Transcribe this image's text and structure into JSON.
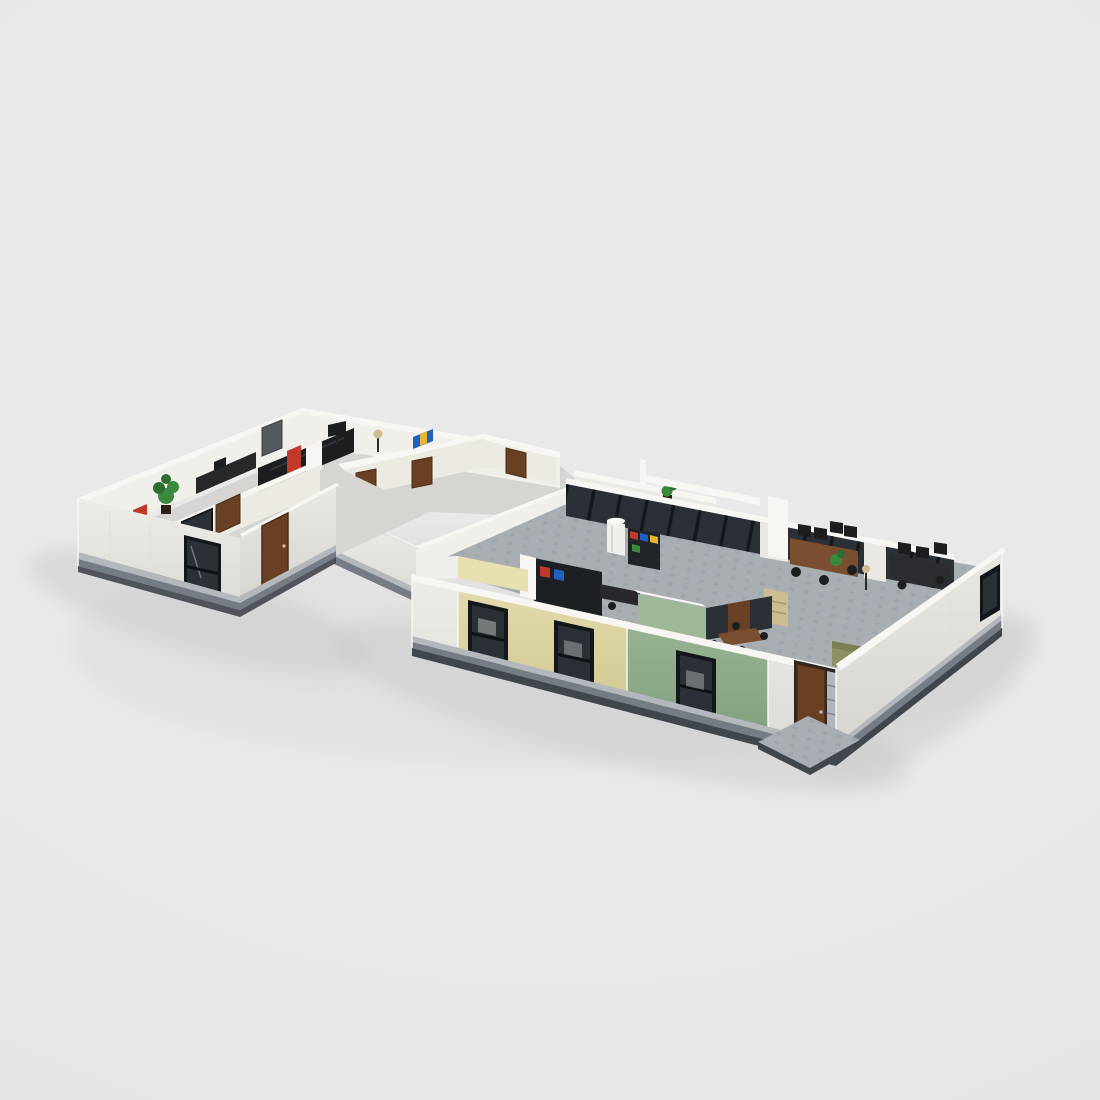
{
  "scene": {
    "description": "Isometric digital render of a LEGO-style office building model (open-top floor plan with two connected wings) on a plain light gray studio background",
    "style": "LEGO brick MOC render, dollhouse top-open view, no text or UI elements visible",
    "canvas": {
      "width": 1100,
      "height": 1100
    },
    "palette": {
      "bg": "#e9e9e9",
      "bg-edge": "#e1e1e1",
      "shadow": "#c9c9c9",
      "wall": "#eae8e3",
      "wall2": "#e5e3de",
      "wall-top": "#f7f6f3",
      "wall-inner": "#f1efe9",
      "wall-inner2": "#eceae3",
      "base-light": "#b4b8bd",
      "base-dark": "#767c84",
      "plinth": "#41464d",
      "floor-left": "#d7d5d1",
      "floor-tile": "#a9aeb3",
      "stud": "#999fa5",
      "accent-yellow": "#ddd6a2",
      "yellow-inner": "#e7e0b0",
      "accent-green": "#90ad8d",
      "green-inner": "#9fb89a",
      "door-brown": "#6a4024",
      "door-brown-dark": "#4a2c16",
      "glass": "#2b3036",
      "glass-frame": "#14171a",
      "black": "#1b1d1f",
      "graphite": "#55585c",
      "desk": "#7a4f30",
      "red": "#c0392b",
      "blue": "#2060c0",
      "yellow-item": "#e3b72e",
      "tan": "#cdbd92",
      "olive": "#8f9062",
      "plant": "#3a8a3e",
      "plant-dark": "#2c6e31",
      "white-pure": "#f6f5f2",
      "silver": "#b2b6ba"
    },
    "model": {
      "left_wing": {
        "wall_color": "white",
        "front_window_count": 1,
        "side_door": "brown",
        "back_double_door": "dark gray",
        "interior_items": [
          "potted-plant",
          "red-cabinet",
          "black-reception-desk",
          "computer-monitor",
          "white-fridge",
          "floor-lamp",
          "blue-binders",
          "interior-window",
          "interior-door"
        ]
      },
      "middle_section": {
        "type": "hallway with small rooms",
        "brown_door_count": 5,
        "interior_items": [
          "potted-plant",
          "white-partition-walls"
        ]
      },
      "right_wing": {
        "front_wall_sections": [
          "white",
          "pale-yellow",
          "sage-green",
          "white"
        ],
        "front_window_count": 3,
        "side_window_count": 1,
        "entry_door": "brown with silver sidelight grille",
        "floor": "gray studded baseplate tiles",
        "interior_items": [
          "glass-walled-offices",
          "bookshelf-with-colored-books",
          "white-water-tank",
          "desk-cluster-with-monitors",
          "second-desk-cluster",
          "tan-file-cabinet",
          "green-conference-room",
          "conference-table",
          "olive-couch",
          "potted-plant",
          "floor-lamp",
          "white-pillar",
          "entry-patio"
        ]
      }
    }
  }
}
